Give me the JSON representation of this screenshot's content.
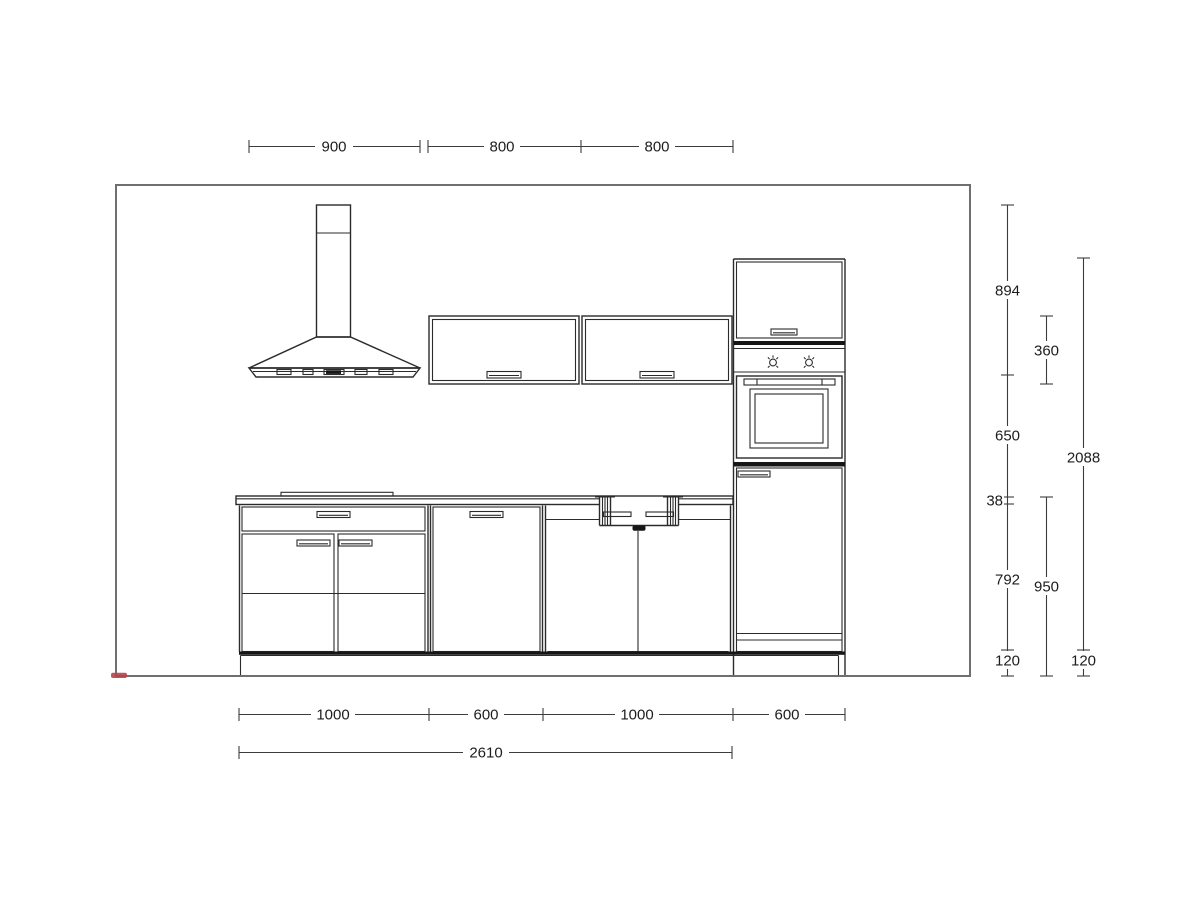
{
  "drawing": {
    "type": "kitchen-elevation",
    "units": "mm"
  },
  "dimensions": {
    "top": [
      "900",
      "800",
      "800"
    ],
    "bottom_segments": [
      "1000",
      "600",
      "1000",
      "600"
    ],
    "bottom_total": "2610",
    "right_heights": [
      "894",
      "650",
      "38",
      "792",
      "120"
    ],
    "right_mid": [
      "360",
      "950"
    ],
    "right_overall": [
      "2088",
      "120"
    ]
  },
  "colors": {
    "wall_outline": "#6f6f6f",
    "furniture_line": "#2b2b2b",
    "dimension_line": "#3c3c3c",
    "accent_red": "#b5454e",
    "background": "#ffffff"
  }
}
